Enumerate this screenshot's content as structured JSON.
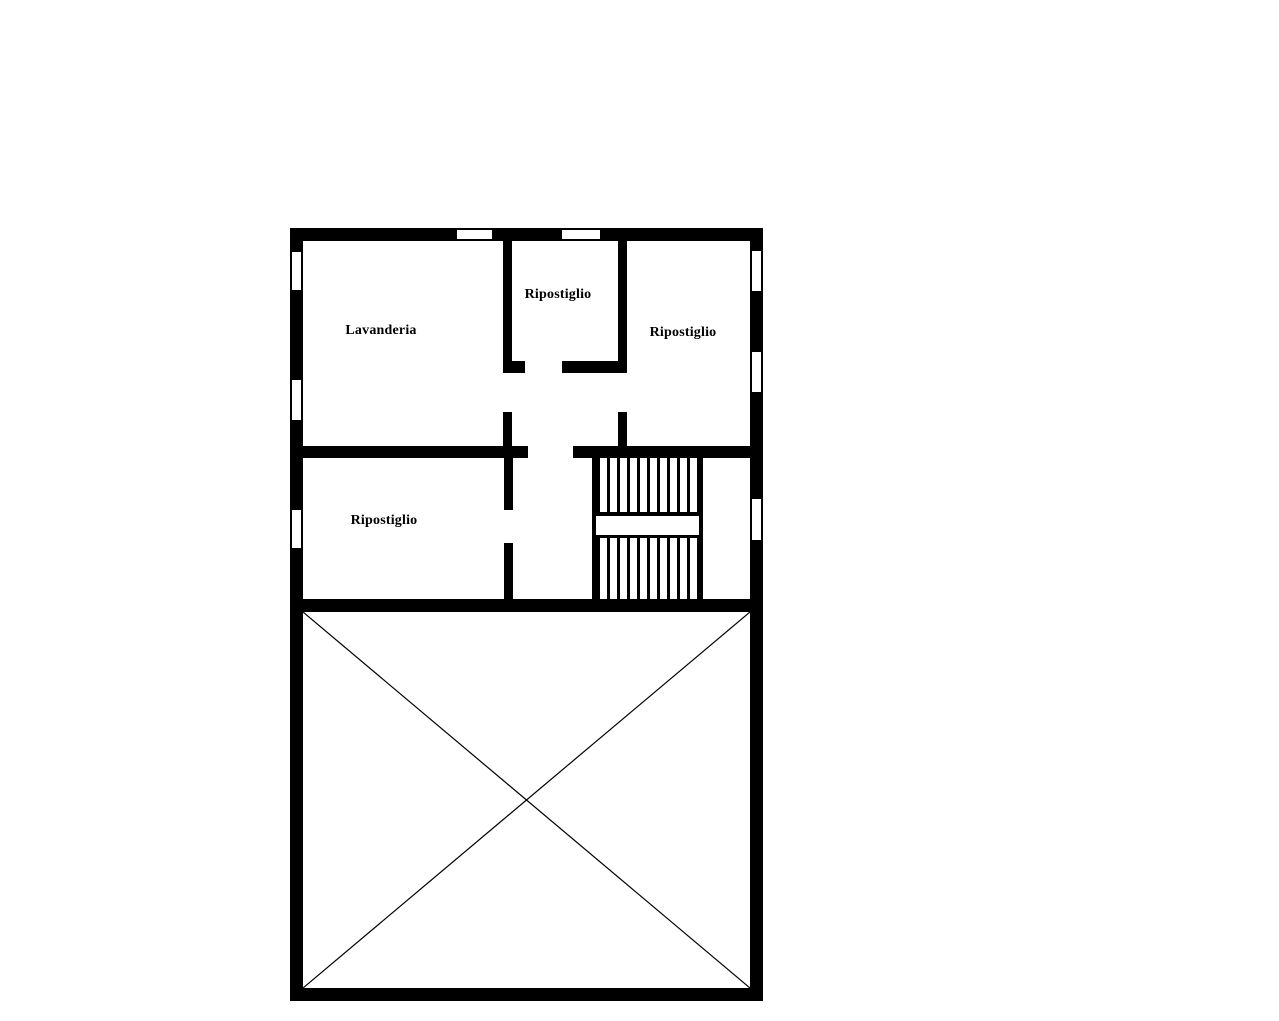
{
  "plan": {
    "type": "floor-plan",
    "colors": {
      "wall": "#000000",
      "floor": "#ffffff",
      "diagonal_line": "#000000",
      "background": "#ffffff"
    },
    "labels": {
      "lavanderia": "Lavanderia",
      "ripostiglio_top_middle": "Ripostiglio",
      "ripostiglio_top_right": "Ripostiglio",
      "ripostiglio_lower_left": "Ripostiglio"
    }
  }
}
